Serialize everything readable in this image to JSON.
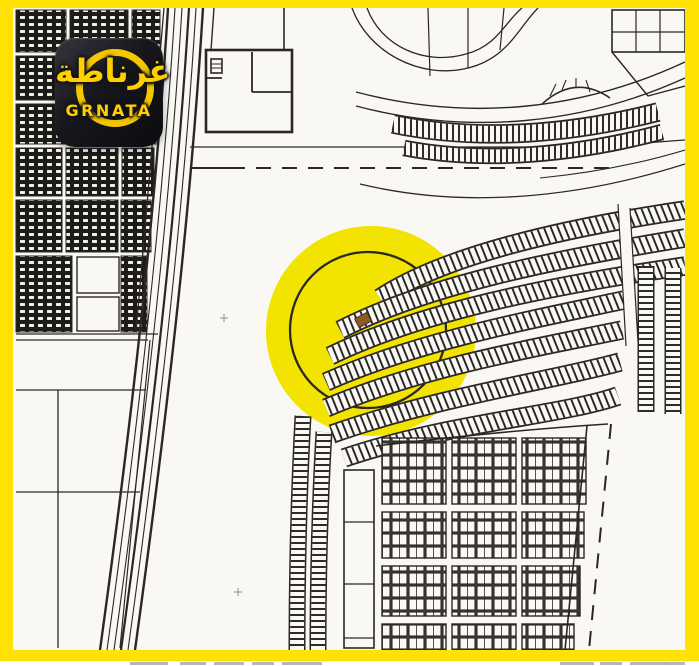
{
  "frame": {
    "border_color": "#FFE103"
  },
  "logo": {
    "arabic_name": "غرناطة",
    "latin_name": "GRNATA",
    "background_color": "#15151B",
    "accent_color": "#FFCF00",
    "swoosh_icon": "s-ring-swoosh"
  },
  "map": {
    "paper_color": "#FAF8F4",
    "ink_color": "#2B2823",
    "highlight_circle": {
      "color": "#F2E400",
      "center_x": 371,
      "center_y": 331,
      "radius": 105
    },
    "location_marker": {
      "color": "#8B5A2B",
      "x": 363,
      "y": 320,
      "rotation_deg": -28
    }
  }
}
